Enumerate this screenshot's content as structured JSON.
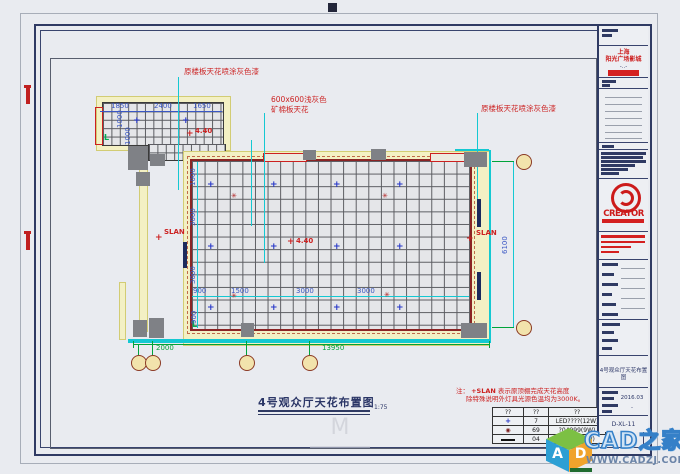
{
  "colors": {
    "accent_red": "#cc2222",
    "dim_blue": "#3a57c4",
    "dim_green": "#00a33a",
    "cyan": "#14c8d2",
    "frame_navy": "#2f3a63",
    "watermark_blue": "#3580c8"
  },
  "main": {
    "title": "4号观众厅天花布置图",
    "scale": "1:75"
  },
  "icons": {
    "downlight": "+",
    "speaker": "✳",
    "redcross": "+",
    "crest": "M"
  },
  "note": {
    "prefix": "注：",
    "symbol": "+SLAN",
    "line1": "表示原顶棚完成天花高度",
    "line2": "除特殊说明外灯具光源色温均为3000K。"
  },
  "legend": {
    "headers": [
      "??",
      "??",
      "??"
    ],
    "rows": [
      {
        "sym": "downlight",
        "qty": "7",
        "desc": "LED????(12W)"
      },
      {
        "sym": "spot",
        "qty": "69",
        "desc": "?04999(9W)"
      },
      {
        "sym": "strip",
        "qty": "04",
        "desc": "led????(?W)"
      }
    ]
  },
  "title_block": {
    "client_line1": "上海",
    "client_line2": "阳光广场影城",
    "client_dash": "-..-",
    "brand": "CREATOR",
    "sheet_name": "4号观众厅天花布置图",
    "date": "2016.03",
    "dash": "-",
    "number": "D-XL-11"
  },
  "watermark": {
    "brand": "CAD之家",
    "url": "WWW.CADZJ.COM",
    "cube_letter_a": "A",
    "cube_letter_d": "D"
  },
  "scene": {
    "texts": [
      {
        "t": "原楼板天花喷涂灰色漆",
        "x": 184,
        "y": 68,
        "cls": "red"
      },
      {
        "t": "600x600浅灰色",
        "x": 271,
        "y": 96,
        "cls": "red"
      },
      {
        "t": "矿棉板天花",
        "x": 271,
        "y": 106,
        "cls": "red"
      },
      {
        "t": "原楼板天花喷涂灰色漆",
        "x": 481,
        "y": 105,
        "cls": "red"
      },
      {
        "t": "4.40",
        "x": 296,
        "y": 238,
        "cls": "redb"
      },
      {
        "t": "4.40",
        "x": 195,
        "y": 128,
        "cls": "redb"
      },
      {
        "t": "SLAN",
        "x": 164,
        "y": 229,
        "cls": "redb"
      },
      {
        "t": "SLAN",
        "x": 476,
        "y": 230,
        "cls": "redb"
      },
      {
        "t": "1850",
        "x": 111,
        "y": 103,
        "cls": "dim"
      },
      {
        "t": "2400",
        "x": 154,
        "y": 103,
        "cls": "dim"
      },
      {
        "t": "1650",
        "x": 193,
        "y": 103,
        "cls": "dim"
      },
      {
        "t": "1000",
        "x": 117,
        "y": 128,
        "cls": "dim",
        "rot": 1
      },
      {
        "t": "1000",
        "x": 125,
        "y": 145,
        "cls": "dim",
        "rot": 1
      },
      {
        "t": "1000",
        "x": 190,
        "y": 186,
        "cls": "dim",
        "rot": 1
      },
      {
        "t": "3000",
        "x": 190,
        "y": 226,
        "cls": "dim",
        "rot": 1
      },
      {
        "t": "3000",
        "x": 190,
        "y": 284,
        "cls": "dim",
        "rot": 1
      },
      {
        "t": "900",
        "x": 191,
        "y": 324,
        "cls": "dim",
        "rot": 1
      },
      {
        "t": "900",
        "x": 193,
        "y": 288,
        "cls": "dim"
      },
      {
        "t": "1500",
        "x": 231,
        "y": 288,
        "cls": "dim"
      },
      {
        "t": "3000",
        "x": 296,
        "y": 288,
        "cls": "dim"
      },
      {
        "t": "3000",
        "x": 357,
        "y": 288,
        "cls": "dim"
      },
      {
        "t": "6100",
        "x": 502,
        "y": 254,
        "cls": "dim",
        "rot": 1
      },
      {
        "t": "2000",
        "x": 156,
        "y": 345,
        "cls": "gdim"
      },
      {
        "t": "13950",
        "x": 322,
        "y": 345,
        "cls": "gdim"
      }
    ],
    "symbols": [
      {
        "k": "downlight",
        "x": 207,
        "y": 181
      },
      {
        "k": "downlight",
        "x": 270,
        "y": 181
      },
      {
        "k": "downlight",
        "x": 333,
        "y": 181
      },
      {
        "k": "downlight",
        "x": 396,
        "y": 181
      },
      {
        "k": "downlight",
        "x": 207,
        "y": 243
      },
      {
        "k": "downlight",
        "x": 270,
        "y": 243
      },
      {
        "k": "downlight",
        "x": 333,
        "y": 243
      },
      {
        "k": "downlight",
        "x": 396,
        "y": 243
      },
      {
        "k": "downlight",
        "x": 207,
        "y": 304
      },
      {
        "k": "downlight",
        "x": 270,
        "y": 304
      },
      {
        "k": "downlight",
        "x": 333,
        "y": 304
      },
      {
        "k": "downlight",
        "x": 396,
        "y": 304
      },
      {
        "k": "downlight",
        "x": 133,
        "y": 117
      },
      {
        "k": "downlight",
        "x": 182,
        "y": 117
      },
      {
        "k": "speaker",
        "x": 231,
        "y": 193
      },
      {
        "k": "speaker",
        "x": 382,
        "y": 193
      },
      {
        "k": "speaker",
        "x": 231,
        "y": 293
      },
      {
        "k": "speaker",
        "x": 384,
        "y": 292
      },
      {
        "k": "redcross",
        "x": 287,
        "y": 238
      },
      {
        "k": "redcross",
        "x": 186,
        "y": 130
      },
      {
        "k": "redcross",
        "x": 155,
        "y": 234
      },
      {
        "k": "redcross",
        "x": 466,
        "y": 235
      }
    ],
    "bubbles": [
      [
        131,
        355
      ],
      [
        145,
        355
      ],
      [
        239,
        355
      ],
      [
        302,
        355
      ],
      [
        516,
        154
      ],
      [
        516,
        320
      ]
    ]
  }
}
